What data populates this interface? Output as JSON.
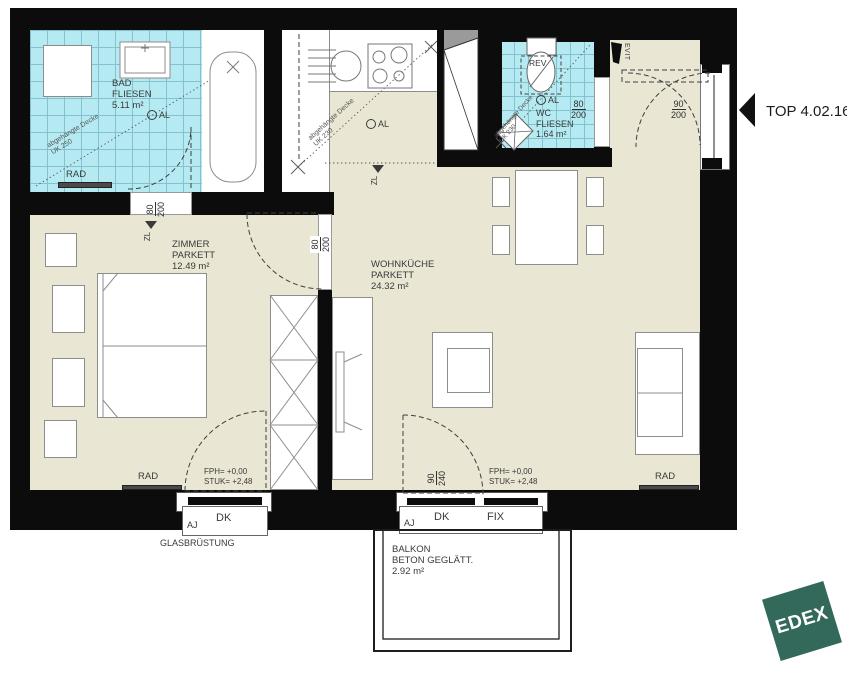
{
  "title": {
    "top_label": "TOP 4.02.16"
  },
  "logo": {
    "text": "EDEX",
    "color": "#33695B"
  },
  "rooms": {
    "bad": {
      "name": "BAD",
      "finish": "FLIESEN",
      "area": "5.11 m²"
    },
    "zimmer": {
      "name": "ZIMMER",
      "finish": "PARKETT",
      "area": "12.49 m²"
    },
    "wohnkueche": {
      "name": "WOHNKÜCHE",
      "finish": "PARKETT",
      "area": "24.32 m²"
    },
    "wc": {
      "name": "WC",
      "finish": "FLIESEN",
      "area": "1.64 m²"
    },
    "balkon": {
      "name": "BALKON",
      "finish": "BETON GEGLÄTT.",
      "area": "2.92 m²"
    }
  },
  "doors": {
    "bad_door": {
      "num": "80",
      "den": "200"
    },
    "zimmer_door": {
      "num": "80",
      "den": "200"
    },
    "wc_door": {
      "num": "80",
      "den": "200"
    },
    "entry_door": {
      "num": "90",
      "den": "200"
    },
    "balcony_door": {
      "num": "90",
      "den": "240"
    }
  },
  "levels": {
    "fph": "FPH= +0,00",
    "stuk": "STUK= +2,48"
  },
  "annotations": {
    "rad": "RAD",
    "al": "AL",
    "zl": "ZL",
    "rev": "REV",
    "evit": "EVIT",
    "aj": "AJ",
    "dk": "DK",
    "fix": "FIX",
    "glasbruestung": "GLASBRÜSTUNG",
    "ceiling_bad": {
      "line1": "abgehängte Decke",
      "line2": "UK 250"
    },
    "ceiling_kueche": {
      "line1": "abgehängte Decke",
      "line2": "UK 230"
    },
    "ceiling_wc": {
      "line1": "abgehängte Decke",
      "line2": "UK 230"
    }
  },
  "colors": {
    "tile": "#b6eaf2",
    "floor": "#eae6d4",
    "wall": "#0c0c0c",
    "logo_green": "#33695B"
  }
}
